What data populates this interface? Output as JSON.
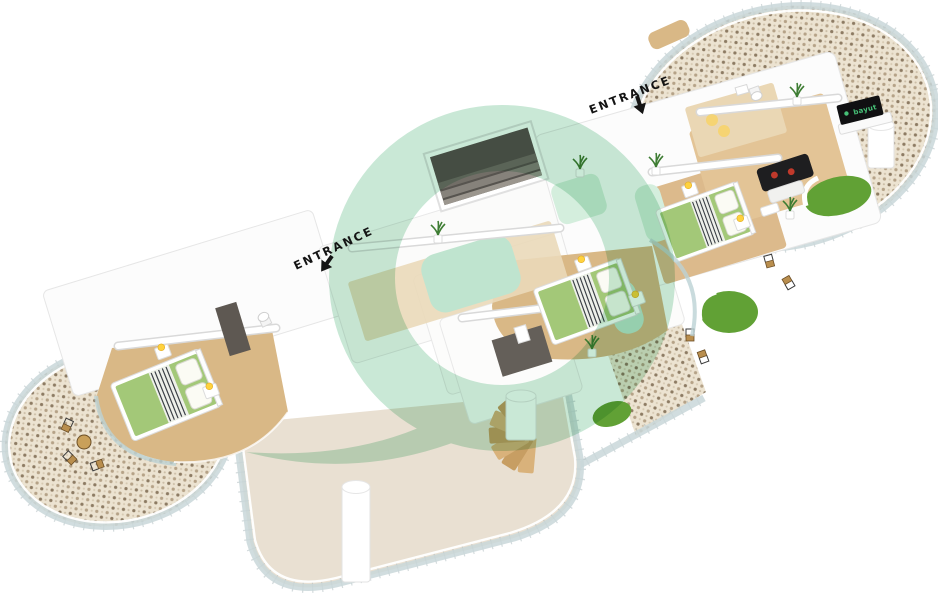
{
  "floorplan": {
    "entrance_labels": {
      "top": "ENTRANCE",
      "middle": "ENTRANCE"
    },
    "tv_brand": "bayut",
    "palette": {
      "background": "#ffffff",
      "watermark_green": "#a7dabd",
      "accent_mint": "#bfe4cf",
      "accent_mint_light": "#d4eedd",
      "wood_floor": "#d9b886",
      "wood_floor_light": "#ead9b9",
      "terrace_stone": "#e9e0d2",
      "mosaic_base": "#ece3d1",
      "mosaic_dot_dark": "#8d7b63",
      "mosaic_dot_mid": "#b5a287",
      "glass": "#c9d7d9",
      "bed_green": "#a3c878",
      "grass_green": "#61a135",
      "sofa_black": "#1e1e20",
      "pillow_red": "#c0392b",
      "lamp_yellow": "#ffd23e",
      "stair_dark": "#57544f",
      "stair_wood": "#d9b27b",
      "chair_brown": "#b98e4e",
      "tv_black": "#101012",
      "tv_green": "#46c077",
      "wall_white": "#fcfcfc",
      "wall_line": "#e2e2e2"
    },
    "furniture_icons": [
      "double-bed",
      "nightstand-lamp",
      "sofa",
      "coffee-table",
      "tv-screen",
      "toilet",
      "shower",
      "spiral-staircase",
      "stairwell",
      "column",
      "potted-plant",
      "balcony-chair",
      "balcony-table",
      "grass-patch",
      "sun-lounger"
    ]
  }
}
